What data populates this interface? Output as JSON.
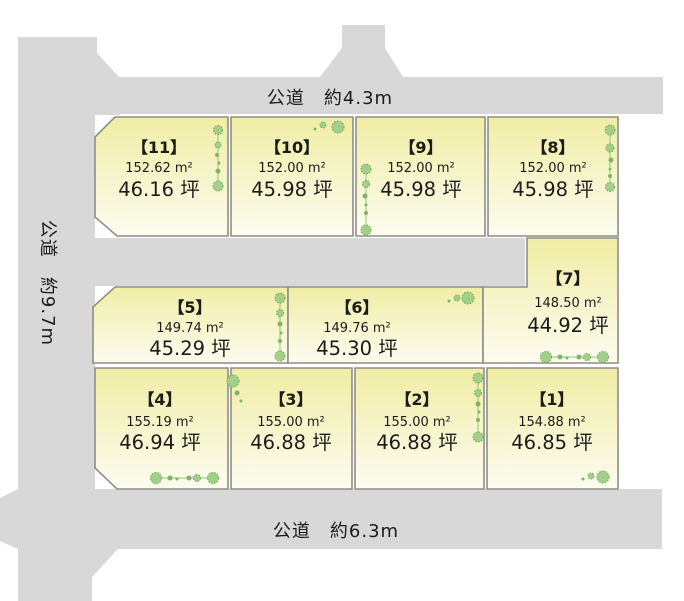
{
  "diagram_title": "宅地区画図",
  "roads": {
    "top": {
      "label": "公道　約4.3m"
    },
    "left": {
      "label": "公道　約9.7m"
    },
    "bottom": {
      "label": "公道　約6.3m"
    }
  },
  "plots": [
    {
      "id": 1,
      "num": "【1】",
      "area_sqm": "154.88 m²",
      "area_tsubo": "46.85 坪"
    },
    {
      "id": 2,
      "num": "【2】",
      "area_sqm": "155.00 m²",
      "area_tsubo": "46.88 坪"
    },
    {
      "id": 3,
      "num": "【3】",
      "area_sqm": "155.00 m²",
      "area_tsubo": "46.88 坪"
    },
    {
      "id": 4,
      "num": "【4】",
      "area_sqm": "155.19 m²",
      "area_tsubo": "46.94 坪"
    },
    {
      "id": 5,
      "num": "【5】",
      "area_sqm": "149.74 m²",
      "area_tsubo": "45.29 坪"
    },
    {
      "id": 6,
      "num": "【6】",
      "area_sqm": "149.76 m²",
      "area_tsubo": "45.30 坪"
    },
    {
      "id": 7,
      "num": "【7】",
      "area_sqm": "148.50 m²",
      "area_tsubo": "44.92 坪"
    },
    {
      "id": 8,
      "num": "【8】",
      "area_sqm": "152.00 m²",
      "area_tsubo": "45.98 坪"
    },
    {
      "id": 9,
      "num": "【9】",
      "area_sqm": "152.00 m²",
      "area_tsubo": "45.98 坪"
    },
    {
      "id": 10,
      "num": "【10】",
      "area_sqm": "152.00 m²",
      "area_tsubo": "45.98 坪"
    },
    {
      "id": 11,
      "num": "【11】",
      "area_sqm": "152.62 m²",
      "area_tsubo": "46.16 坪"
    }
  ],
  "colors": {
    "road": "#d8d8d8",
    "plot_top": "#f0eda4",
    "plot_bottom": "#fdfcf0",
    "plot_border": "#8e8e86",
    "tree_fill": "#a3cf8a",
    "tree_stroke": "#69a850",
    "tree_small": "#7db663",
    "text": "#1b1b1b"
  }
}
